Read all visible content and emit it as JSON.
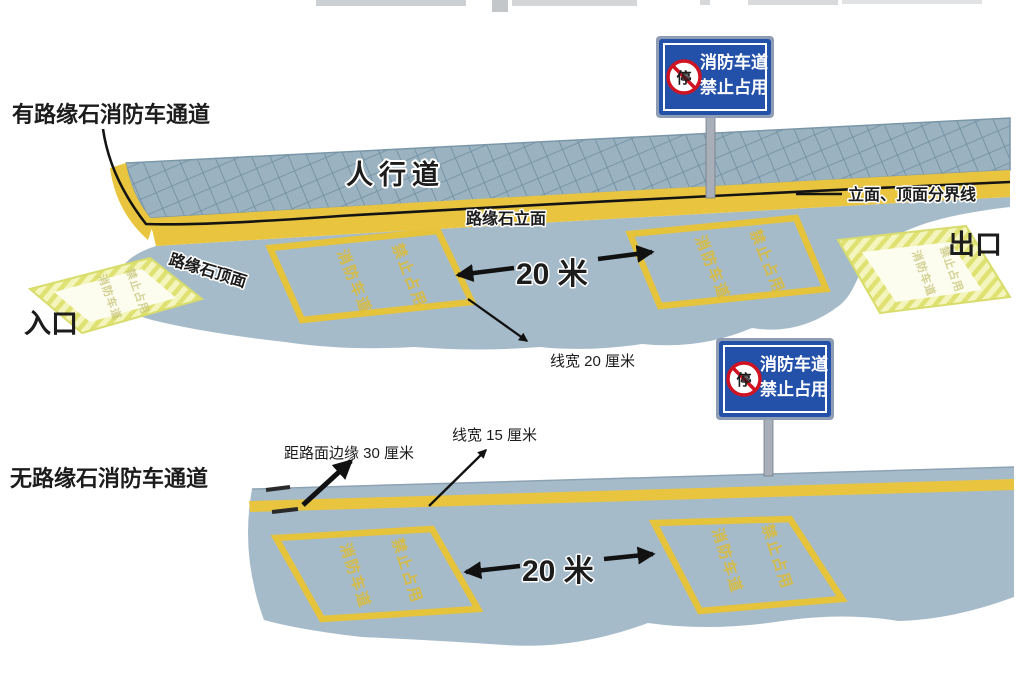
{
  "colors": {
    "road": "#a6bbca",
    "sidewalk": "#9cb4c1",
    "curb_yellow": "#e9c53f",
    "marking_yellow": "#e5c33a",
    "entrance_fill": "#f3f5bd",
    "entrance_hatch": "#dfe272",
    "sign_blue": "#2350a9",
    "prohibit_red": "#cf1322",
    "pole_gray": "#a8afb9"
  },
  "top_diagram": {
    "title": "有路缘石消防车通道",
    "sidewalk_label": "人行道",
    "curb_face_label": "路缘石立面",
    "curb_top_label": "路缘石顶面",
    "boundary_label": "立面、顶面分界线",
    "entrance_label": "入口",
    "exit_label": "出口",
    "length_label": "20 米",
    "line_width_label": "线宽 20 厘米",
    "lane_box_text_left": "消防车道",
    "lane_box_text_right": "禁止占用",
    "sign": {
      "line1": "消防车道",
      "line2": "禁止占用",
      "badge": "停"
    }
  },
  "bottom_diagram": {
    "title": "无路缘石消防车通道",
    "edge_offset_label": "距路面边缘 30 厘米",
    "line_width_label": "线宽 15 厘米",
    "length_label": "20 米",
    "lane_box_text_left": "消防车道",
    "lane_box_text_right": "禁止占用",
    "sign": {
      "line1": "消防车道",
      "line2": "禁止占用",
      "badge": "停"
    }
  }
}
